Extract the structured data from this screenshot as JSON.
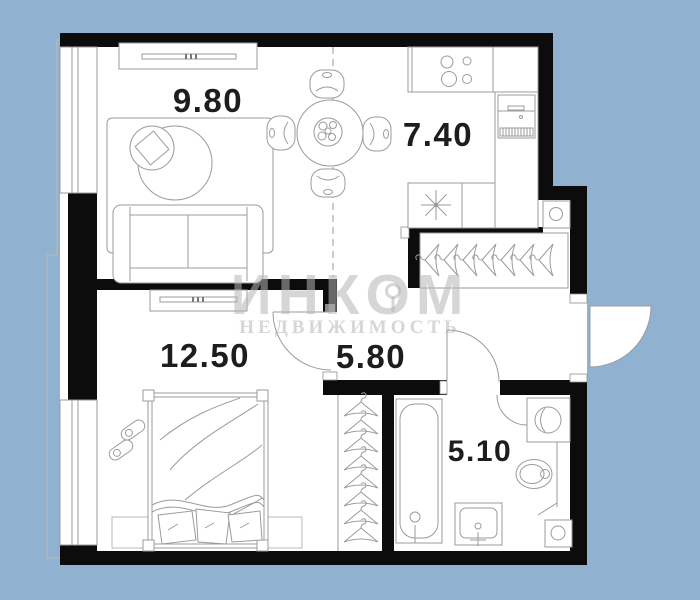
{
  "plan": {
    "type": "apartment-floor-plan",
    "background_color": "#90b2d0",
    "wall_color": "#0c0c0c",
    "furniture_line_color": "#9b9b9b",
    "label_color": "#1d1d1d",
    "watermark": {
      "line1": "ИНКОМ",
      "line2": "НЕДВИЖИМОСТЬ",
      "color": "#b4b4b4"
    },
    "rooms": [
      {
        "id": "living-room",
        "area": "9.80"
      },
      {
        "id": "kitchen",
        "area": "7.40"
      },
      {
        "id": "bedroom",
        "area": "12.50"
      },
      {
        "id": "hallway",
        "area": "5.80"
      },
      {
        "id": "bathroom",
        "area": "5.10"
      }
    ],
    "furniture": [
      "tv-stand",
      "area-rug",
      "ottoman",
      "cushion",
      "sofa",
      "dining-table",
      "dining-chairs",
      "stove",
      "fridge",
      "kitchen-counter",
      "kitchen-sink",
      "coat-rack",
      "ventilation-shaft",
      "wardrobe",
      "dresser",
      "bed",
      "slippers",
      "bedroom-rug",
      "bathtub",
      "washbasin",
      "toilet",
      "washing-machine",
      "duct-box"
    ],
    "counts": {
      "coat_rack_hangers": 7,
      "wardrobe_hangers": 8,
      "dining_chairs": 4,
      "stove_burners": 4
    }
  }
}
